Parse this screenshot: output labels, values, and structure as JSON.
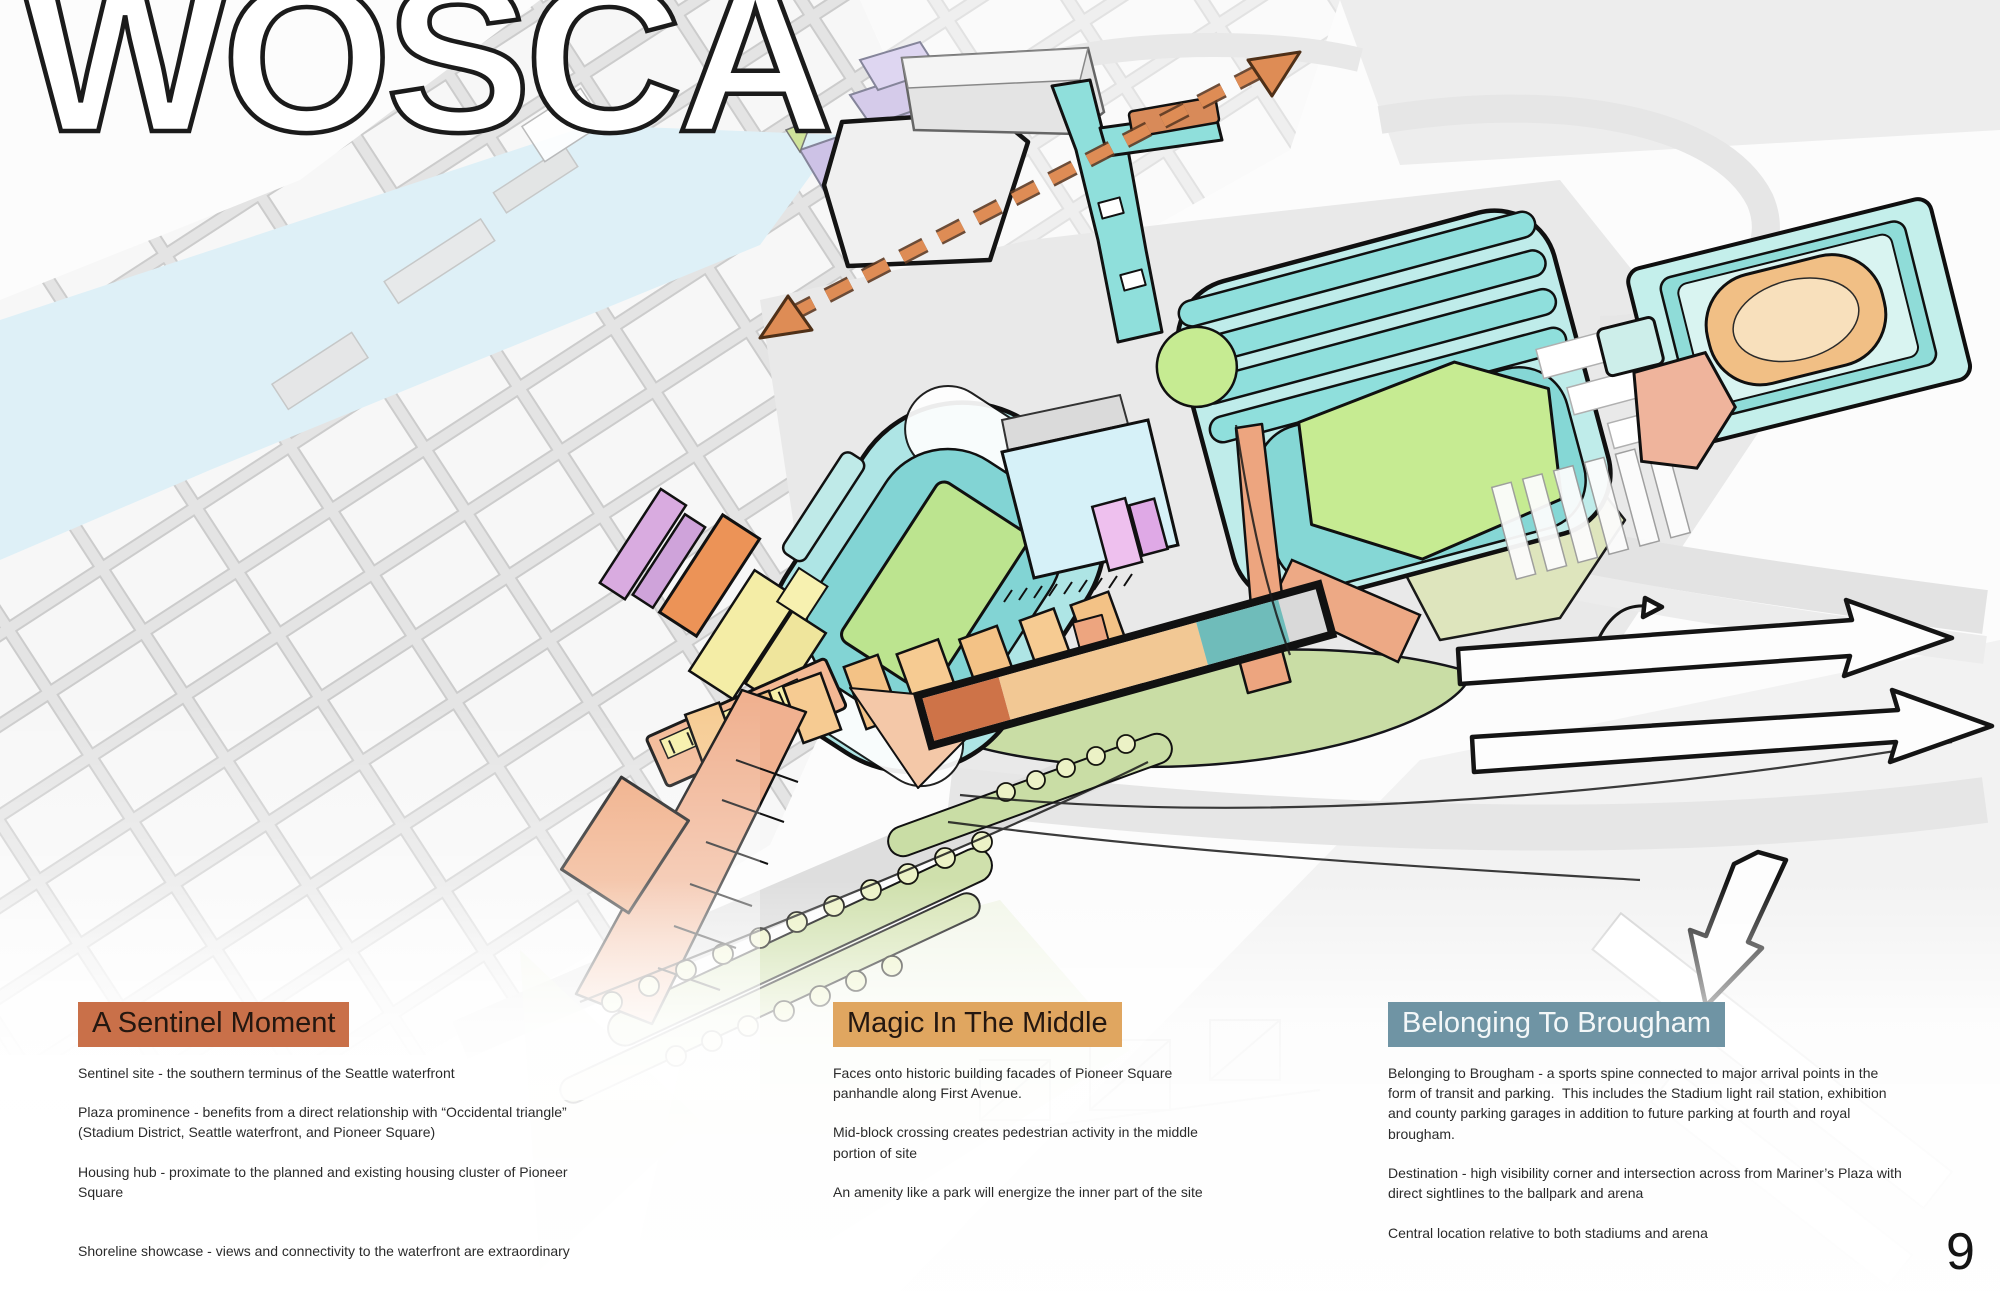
{
  "page": {
    "title": "WOSCA",
    "number": "9"
  },
  "columns": [
    {
      "id": "sentinel",
      "header": "A Sentinel Moment",
      "header_bg": "#C97049",
      "paragraphs": [
        "Sentinel site - the southern terminus of the Seattle waterfront",
        "Plaza prominence - benefits from a direct relationship with “Occidental triangle” (Stadium District, Seattle waterfront, and Pioneer Square)",
        "Housing hub - proximate to the planned and existing housing cluster of Pioneer Square",
        "Shoreline showcase - views and connectivity to the waterfront are extraordinary"
      ]
    },
    {
      "id": "magic",
      "header": "Magic In The Middle",
      "header_bg": "#E0A660",
      "paragraphs": [
        "Faces onto historic building facades of Pioneer Square panhandle along First Avenue.",
        "Mid-block crossing creates pedestrian activity in the middle portion of site",
        "An amenity like a park will energize the inner part of the site"
      ]
    },
    {
      "id": "brougham",
      "header": "Belonging To Brougham",
      "header_bg": "#6F94A4",
      "paragraphs": [
        "Belonging to Brougham - a sports spine connected to major arrival points in the form of transit and parking.  This includes the Stadium light rail station, exhibition and county parking garages in addition to future parking at fourth and royal brougham.",
        "Destination - high visibility corner and intersection across from Mariner’s Plaza with direct sightlines to the ballpark and arena",
        "Central location relative to both stadiums and arena"
      ]
    }
  ],
  "map": {
    "palette": {
      "water": "#DEF0F7",
      "stadium_teal": "#AEE5E5",
      "field_green": "#BCE48F",
      "arena_dome_orange": "#F1BF85",
      "site_segment_dark_orange": "#CE7348",
      "site_segment_tan": "#F2C894",
      "site_segment_teal": "#6FBCBA",
      "transit_arrow_orange": "#DE8C55",
      "landscape_green": "#C9DDA5",
      "promenade_salmon": "#F0B190",
      "lavender_buildings": "#D5CBEA",
      "yellow_buildings": "#F4EDA6"
    }
  }
}
